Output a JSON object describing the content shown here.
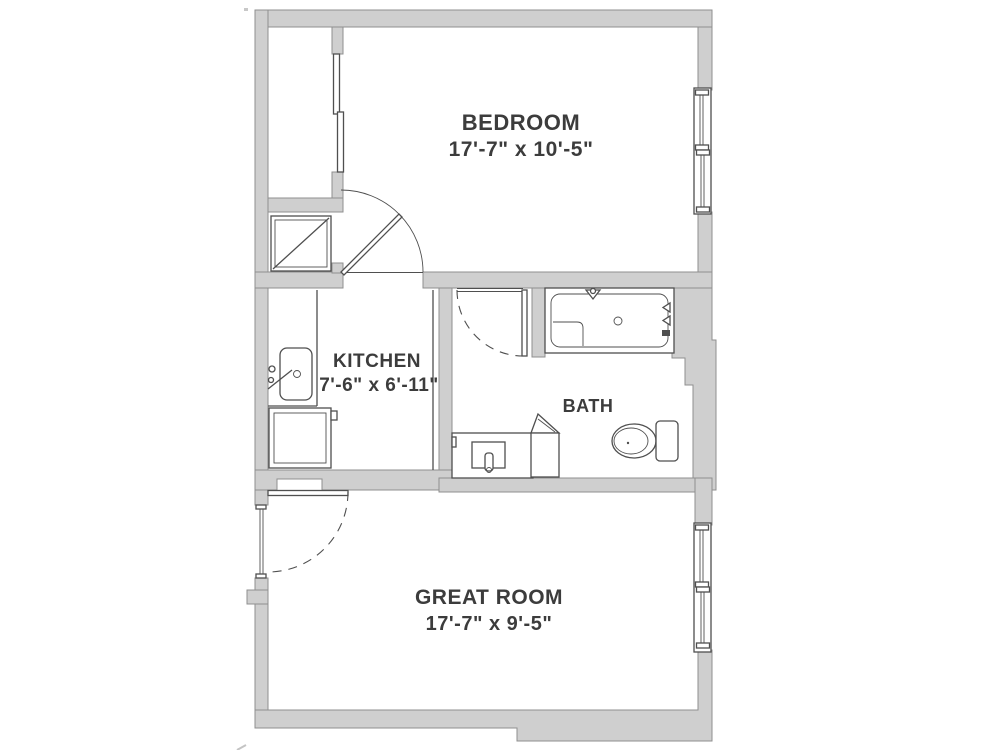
{
  "floor_plan": {
    "rooms": [
      {
        "id": "bedroom",
        "name": "BEDROOM",
        "dimensions": "17'-7\" x 10'-5\""
      },
      {
        "id": "kitchen",
        "name": "KITCHEN",
        "dimensions": "7'-6\" x 6'-11\""
      },
      {
        "id": "bath",
        "name": "BATH"
      },
      {
        "id": "great-room",
        "name": "GREAT ROOM",
        "dimensions": "17'-7\" x 9'-5\""
      }
    ],
    "fixtures": [
      "closet-bypass-doors",
      "washer-dryer",
      "kitchen-sink",
      "range",
      "bathtub-shower",
      "toilet",
      "vanity-sink",
      "linen-cabinet",
      "entry-door",
      "bedroom-door",
      "bath-door",
      "bedroom-window",
      "great-room-window"
    ],
    "theme": {
      "wall_fill": "#cfcfcf",
      "wall_stroke": "#8f8f8f",
      "line_color": "#4f4f4f",
      "text_color": "#3c3c3c",
      "bg_color": "#ffffff"
    }
  }
}
